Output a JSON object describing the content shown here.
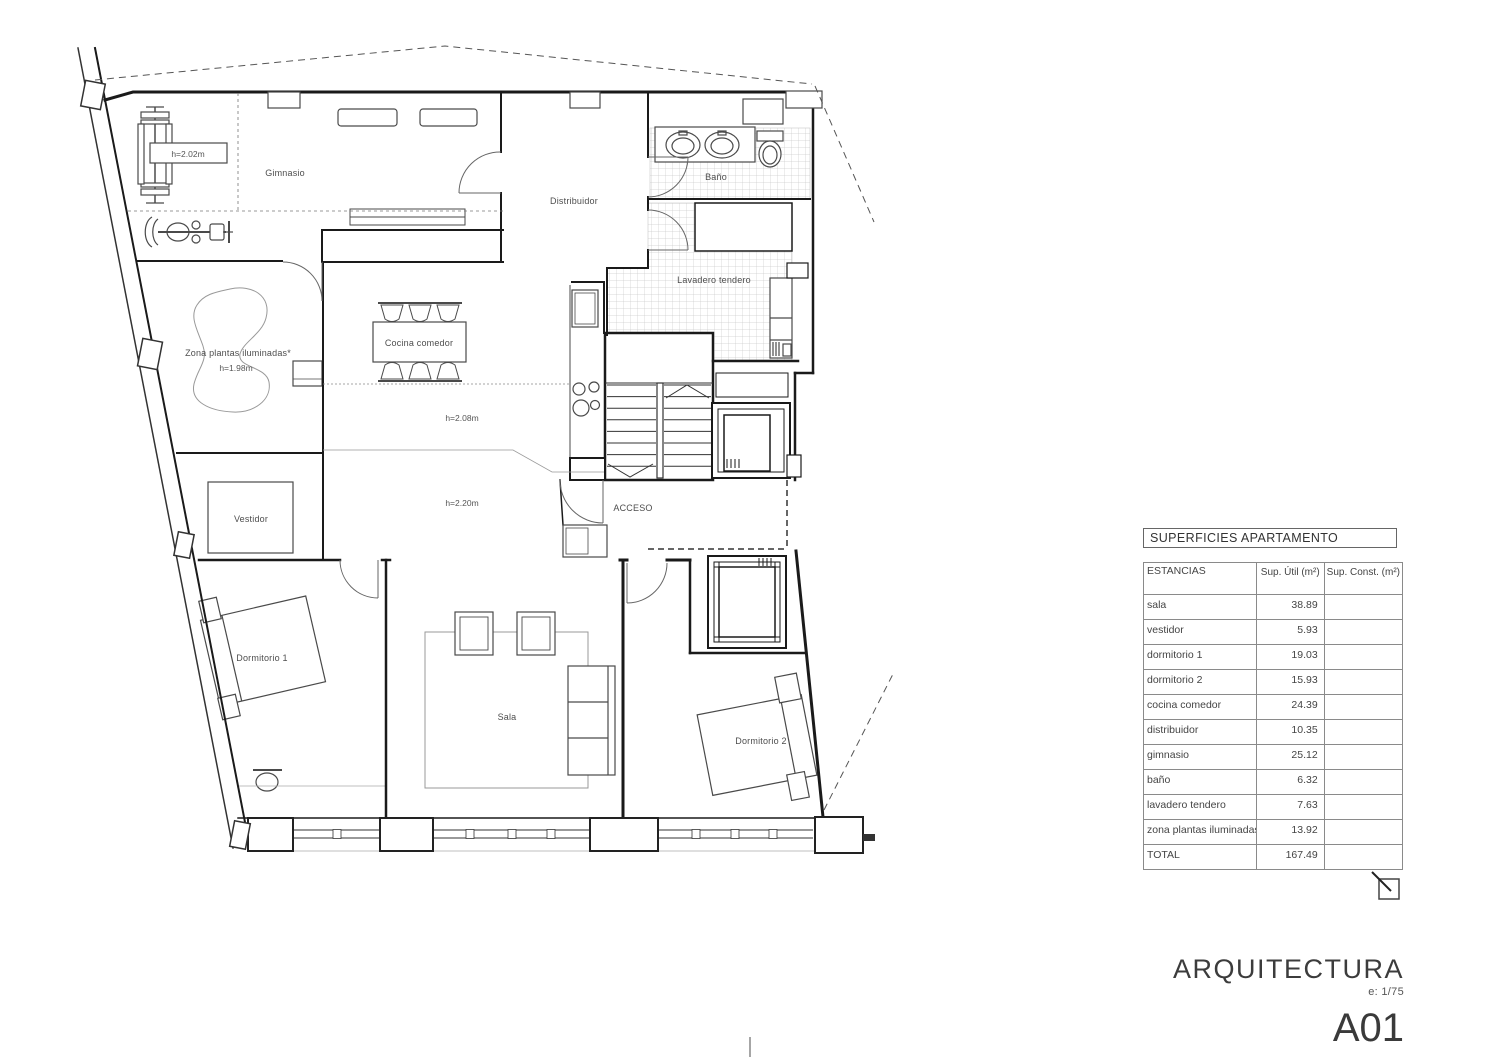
{
  "plan": {
    "labels": {
      "gimnasio": "Gimnasio",
      "gym_height": "h=2.02m",
      "distribuidor": "Distribuidor",
      "bano": "Baño",
      "lavadero": "Lavadero tendero",
      "zona_plantas": "Zona plantas iluminadas*",
      "zona_height": "h=1.98m",
      "cocina": "Cocina comedor",
      "altura_208": "h=2.08m",
      "altura_220": "h=2.20m",
      "acceso": "ACCESO",
      "vestidor": "Vestidor",
      "dormitorio1": "Dormitorio 1",
      "sala": "Sala",
      "dormitorio2": "Dormitorio 2"
    }
  },
  "table": {
    "title": "SUPERFICIES APARTAMENTO",
    "columns": [
      "ESTANCIAS",
      "Sup. Útil (m²)",
      "Sup. Const. (m²)"
    ],
    "rows": [
      {
        "label": "sala",
        "util": "38.89",
        "const": ""
      },
      {
        "label": "vestidor",
        "util": "5.93",
        "const": ""
      },
      {
        "label": "dormitorio 1",
        "util": "19.03",
        "const": ""
      },
      {
        "label": "dormitorio 2",
        "util": "15.93",
        "const": ""
      },
      {
        "label": "cocina comedor",
        "util": "24.39",
        "const": ""
      },
      {
        "label": "distribuidor",
        "util": "10.35",
        "const": ""
      },
      {
        "label": "gimnasio",
        "util": "25.12",
        "const": ""
      },
      {
        "label": "baño",
        "util": "6.32",
        "const": ""
      },
      {
        "label": "lavadero tendero",
        "util": "7.63",
        "const": ""
      },
      {
        "label": "zona plantas iluminadas*",
        "util": "13.92",
        "const": ""
      },
      {
        "label": "TOTAL",
        "util": "167.49",
        "const": ""
      }
    ]
  },
  "titleblock": {
    "discipline": "ARQUITECTURA",
    "scale": "e: 1/75",
    "sheet": "A01"
  }
}
